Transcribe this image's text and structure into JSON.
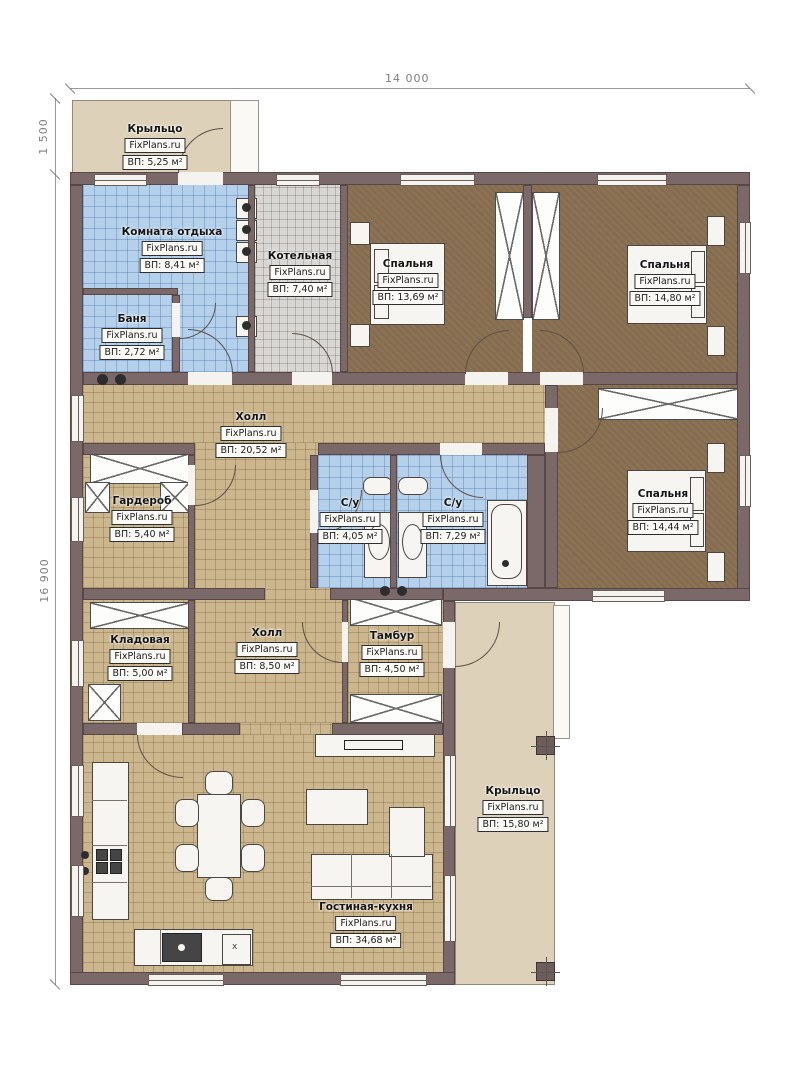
{
  "plan": {
    "type": "floor-plan",
    "brand": "FixPlans.ru",
    "dimensions": {
      "width_top": "14 000",
      "height_left_total": "16 900",
      "height_left_porch": "1 500"
    },
    "colors": {
      "wall": "#7b6969",
      "tile_blue": "#b4d0ea",
      "tile_gray": "#d8d7d4",
      "tile_tan": "#ccb68d",
      "floor_brown": "#8b7254",
      "porch_beige": "#ddd1ba"
    }
  },
  "symbols": {
    "x_mark": "x"
  },
  "rooms": [
    {
      "name": "Крыльцо",
      "watermark": "FixPlans.ru",
      "area": "ВП: 5,25 м²"
    },
    {
      "name": "Комната отдыха",
      "watermark": "FixPlans.ru",
      "area": "ВП: 8,41 м²"
    },
    {
      "name": "Котельная",
      "watermark": "FixPlans.ru",
      "area": "ВП: 7,40 м²"
    },
    {
      "name": "Спальня",
      "watermark": "FixPlans.ru",
      "area": "ВП: 13,69 м²"
    },
    {
      "name": "Спальня",
      "watermark": "FixPlans.ru",
      "area": "ВП: 14,80 м²"
    },
    {
      "name": "Баня",
      "watermark": "FixPlans.ru",
      "area": "ВП: 2,72 м²"
    },
    {
      "name": "Холл",
      "watermark": "FixPlans.ru",
      "area": "ВП: 20,52 м²"
    },
    {
      "name": "Гардероб",
      "watermark": "FixPlans.ru",
      "area": "ВП: 5,40 м²"
    },
    {
      "name": "С/у",
      "watermark": "FixPlans.ru",
      "area": "ВП: 4,05 м²"
    },
    {
      "name": "С/у",
      "watermark": "FixPlans.ru",
      "area": "ВП: 7,29 м²"
    },
    {
      "name": "Спальня",
      "watermark": "FixPlans.ru",
      "area": "ВП: 14,44 м²"
    },
    {
      "name": "Кладовая",
      "watermark": "FixPlans.ru",
      "area": "ВП: 5,00 м²"
    },
    {
      "name": "Холл",
      "watermark": "FixPlans.ru",
      "area": "ВП: 8,50 м²"
    },
    {
      "name": "Тамбур",
      "watermark": "FixPlans.ru",
      "area": "ВП: 4,50 м²"
    },
    {
      "name": "Гостиная-кухня",
      "watermark": "FixPlans.ru",
      "area": "ВП: 34,68 м²"
    },
    {
      "name": "Крыльцо",
      "watermark": "FixPlans.ru",
      "area": "ВП: 15,80 м²"
    }
  ]
}
